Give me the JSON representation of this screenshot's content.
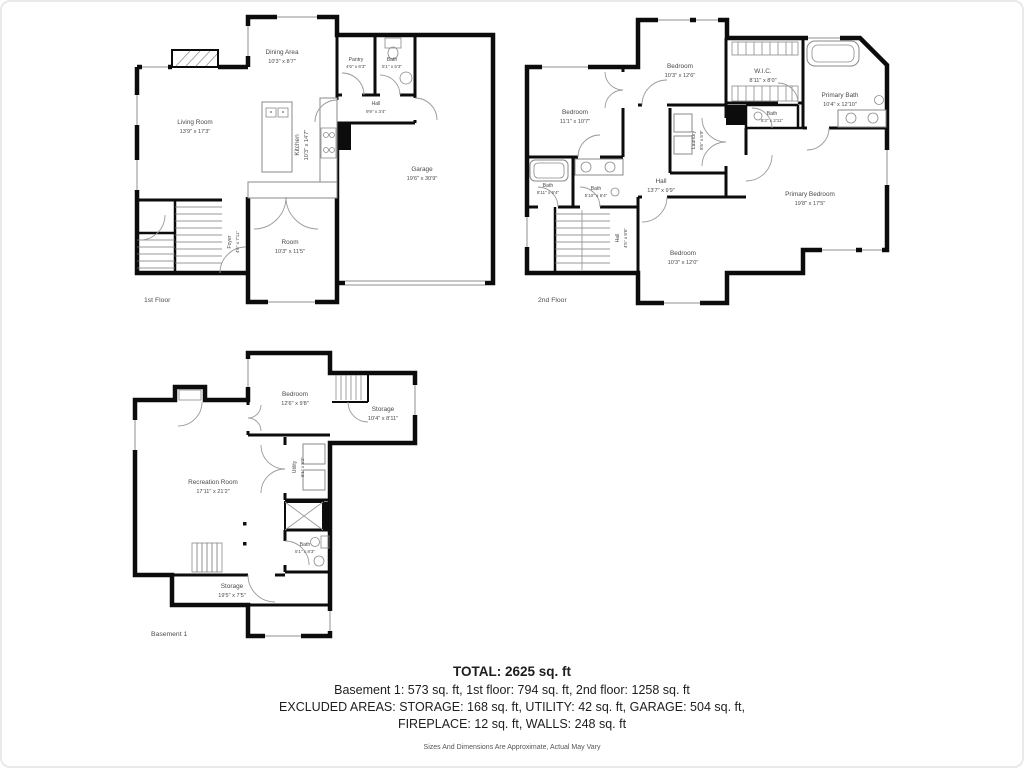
{
  "floors": [
    {
      "name": "1st Floor",
      "rooms": [
        {
          "label": "Dining Area",
          "dims": "10'3\" x 8'7\""
        },
        {
          "label": "Pantry",
          "dims": "4'6\" x 6'3\""
        },
        {
          "label": "Bath",
          "dims": "5'1\" x 5'3\""
        },
        {
          "label": "Hall",
          "dims": "9'9\" x 3'4\""
        },
        {
          "label": "Living Room",
          "dims": "13'9\" x 17'3\""
        },
        {
          "label": "Kitchen",
          "dims": "10'3\" x 14'7\""
        },
        {
          "label": "Garage",
          "dims": "19'6\" x 30'9\""
        },
        {
          "label": "Foyer",
          "dims": "4'6\" x 7'11\""
        },
        {
          "label": "Room",
          "dims": "10'3\" x 11'5\""
        }
      ]
    },
    {
      "name": "2nd Floor",
      "rooms": [
        {
          "label": "Bedroom",
          "dims": "10'3\" x 12'6\""
        },
        {
          "label": "Bedroom",
          "dims": "11'1\" x 10'7\""
        },
        {
          "label": "W.I.C.",
          "dims": "8'11\" x 8'0\""
        },
        {
          "label": "Primary Bath",
          "dims": "10'4\" x 12'10\""
        },
        {
          "label": "Bath",
          "dims": "6'3\" x 2'11\""
        },
        {
          "label": "Laundry",
          "dims": "8'6\" x 5'9\""
        },
        {
          "label": "Bath",
          "dims": "8'11\" x 6'4\""
        },
        {
          "label": "Bath",
          "dims": "5'10\" x 6'4\""
        },
        {
          "label": "Hall",
          "dims": "13'7\" x 9'9\""
        },
        {
          "label": "Hall",
          "dims": "4'5\" x 8'6\""
        },
        {
          "label": "Bedroom",
          "dims": "10'3\" x 12'0\""
        },
        {
          "label": "Primary Bedroom",
          "dims": "19'8\" x 17'5\""
        }
      ]
    },
    {
      "name": "Basement 1",
      "rooms": [
        {
          "label": "Bedroom",
          "dims": "12'6\" x 9'8\""
        },
        {
          "label": "Storage",
          "dims": "10'4\" x 8'11\""
        },
        {
          "label": "Recreation Room",
          "dims": "17'11\" x 21'2\""
        },
        {
          "label": "Utility",
          "dims": "5'1\" x 8'2\""
        },
        {
          "label": "Bath",
          "dims": "5'1\" x 8'3\""
        },
        {
          "label": "Storage",
          "dims": "19'5\" x 7'5\""
        }
      ]
    }
  ],
  "summary": {
    "total": "TOTAL: 2625 sq. ft",
    "line1": "Basement 1: 573 sq. ft, 1st floor: 794 sq. ft, 2nd floor: 1258 sq. ft",
    "line2": "EXCLUDED AREAS: STORAGE: 168 sq. ft, UTILITY: 42 sq. ft, GARAGE: 504 sq. ft,",
    "line3": "FIREPLACE: 12 sq. ft, WALLS: 248 sq. ft",
    "disclaimer": "Sizes And Dimensions Are Approximate, Actual May Vary"
  }
}
